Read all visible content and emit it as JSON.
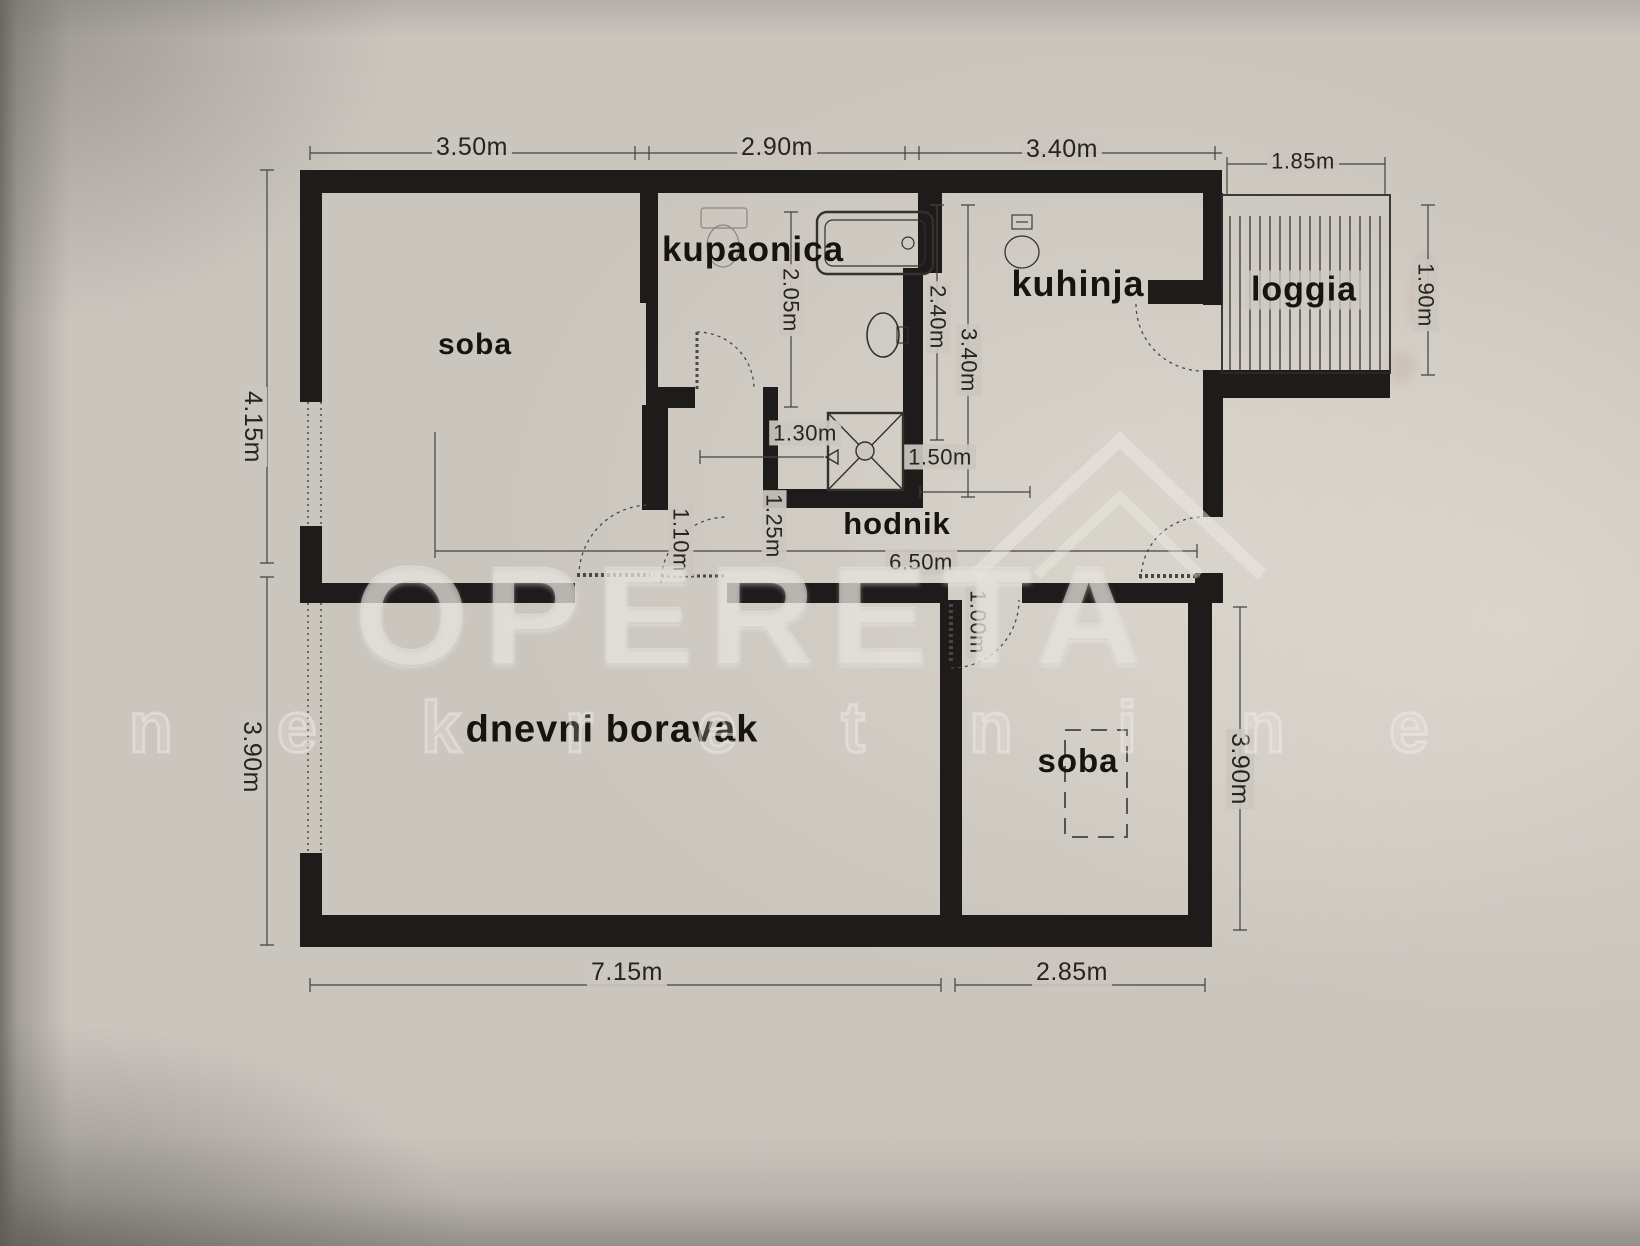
{
  "colors": {
    "paper": "#cac5bd",
    "wall": "#1d1c1a",
    "ink": "#201f1c",
    "dim_line": "#44423e",
    "watermark": "#eeeae3"
  },
  "watermark": {
    "brand": "OPERETA",
    "tagline": "n e k r e t n i n e"
  },
  "rooms": {
    "soba1": "soba",
    "kupaonica": "kupaonica",
    "kuhinja": "kuhinja",
    "loggia": "loggia",
    "hodnik": "hodnik",
    "dnevni_boravak": "dnevni boravak",
    "soba2": "soba"
  },
  "dims": {
    "top_soba": "3.50m",
    "top_kupaonica": "2.90m",
    "top_kuhinja": "3.40m",
    "top_loggia": "1.85m",
    "left_upper": "4.15m",
    "left_lower": "3.90m",
    "right_loggia": "1.90m",
    "right_soba": "3.90m",
    "bottom_dnevni": "7.15m",
    "bottom_soba": "2.85m",
    "bath_depth": "2.05m",
    "bath_width": "2.40m",
    "kitchen_depth": "3.40m",
    "niche_width": "1.30m",
    "hall_east": "1.50m",
    "door_dnevni": "1.10m",
    "hall_width": "1.25m",
    "hall_length": "6.50m",
    "door_soba": "1.00m"
  }
}
